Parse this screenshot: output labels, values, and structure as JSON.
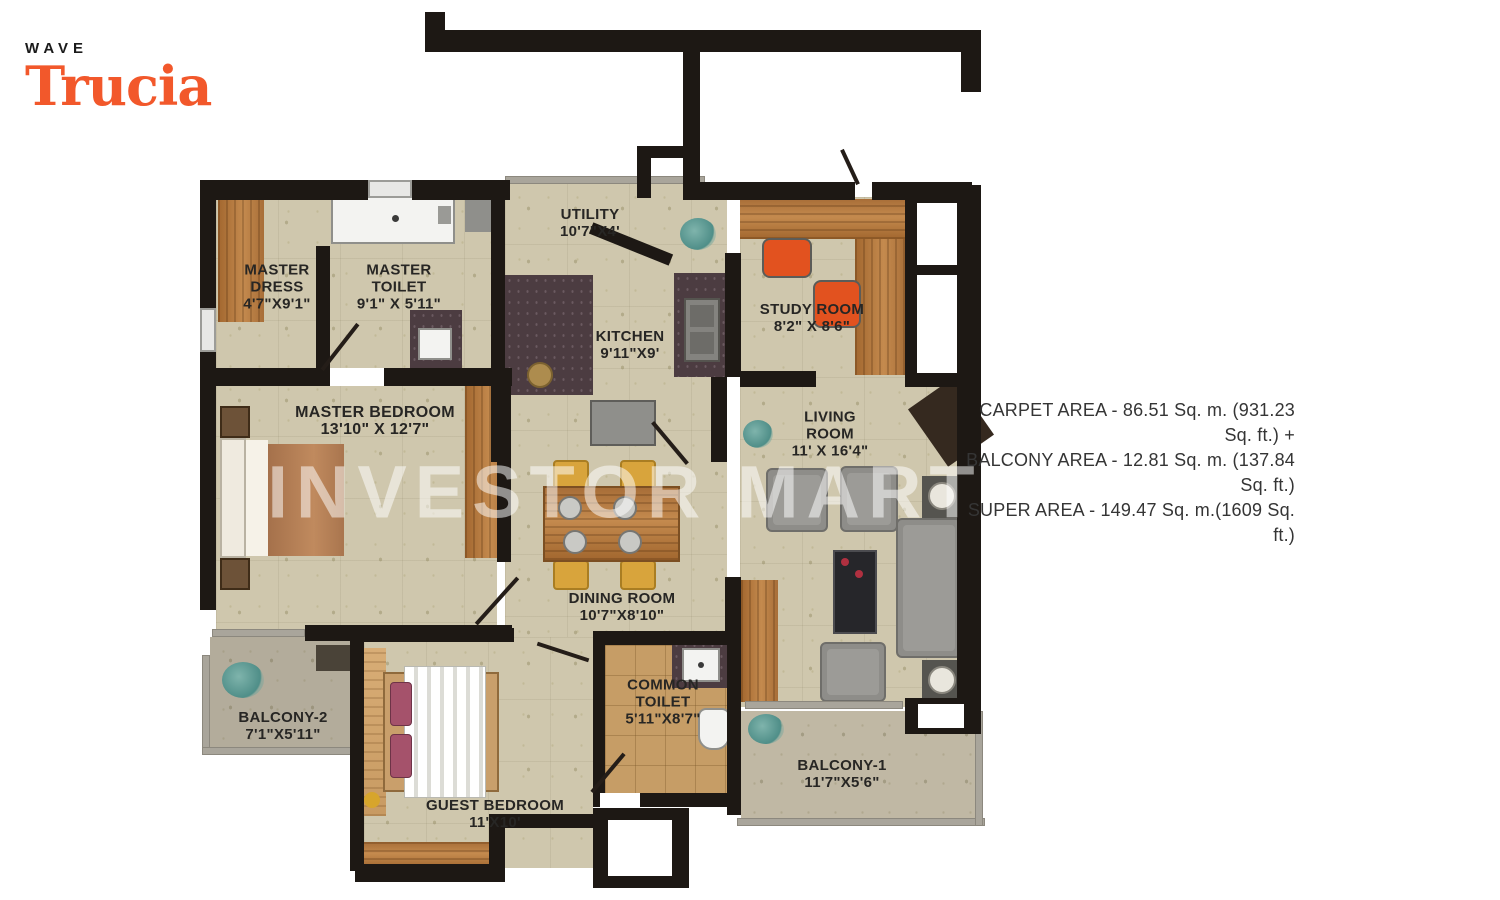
{
  "brand": {
    "name": "WAVE",
    "product": "Trucia",
    "accent_color": "#F2582B"
  },
  "watermark": "INVESTOR MART",
  "area_summary": {
    "line1": "CARPET AREA - 86.51 Sq. m. (931.23 Sq. ft.) +",
    "line2": "BALCONY AREA - 12.81 Sq. m. (137.84 Sq. ft.)",
    "line3": "SUPER AREA - 149.47 Sq. m.(1609 Sq. ft.)"
  },
  "colors": {
    "wall": "#1d1814",
    "floor": "#cfc7ad",
    "balcony_floor": "#b3ac9b",
    "toilet_tile": "#c69d66",
    "wood": "#b97c47",
    "counter": "#4c3c41",
    "sofa": "#8e8d89",
    "chair_orange": "#e2521f"
  },
  "rooms": {
    "master_dress": {
      "lines": [
        "MASTER",
        "DRESS",
        "4'7\"X9'1\""
      ]
    },
    "master_toilet": {
      "lines": [
        "MASTER",
        "TOILET",
        "9'1\" X 5'11\""
      ]
    },
    "utility": {
      "lines": [
        "UTILITY",
        "10'7\"X4'"
      ]
    },
    "kitchen": {
      "lines": [
        "KITCHEN",
        "9'11\"X9'"
      ]
    },
    "study": {
      "lines": [
        "STUDY ROOM",
        "8'2\" X 8'6\""
      ]
    },
    "master_bedroom": {
      "lines": [
        "MASTER BEDROOM",
        "13'10\" X 12'7\""
      ]
    },
    "living": {
      "lines": [
        "LIVING",
        "ROOM",
        "11' X 16'4\""
      ]
    },
    "dining": {
      "lines": [
        "DINING ROOM",
        "10'7\"X8'10\""
      ]
    },
    "balcony2": {
      "lines": [
        "BALCONY-2",
        "7'1\"X5'11\""
      ]
    },
    "guest_bedroom": {
      "lines": [
        "GUEST BEDROOM",
        "11'X10'"
      ]
    },
    "common_toilet": {
      "lines": [
        "COMMON",
        "TOILET",
        "5'11\"X8'7\""
      ]
    },
    "balcony1": {
      "lines": [
        "BALCONY-1",
        "11'7\"X5'6\""
      ]
    }
  }
}
